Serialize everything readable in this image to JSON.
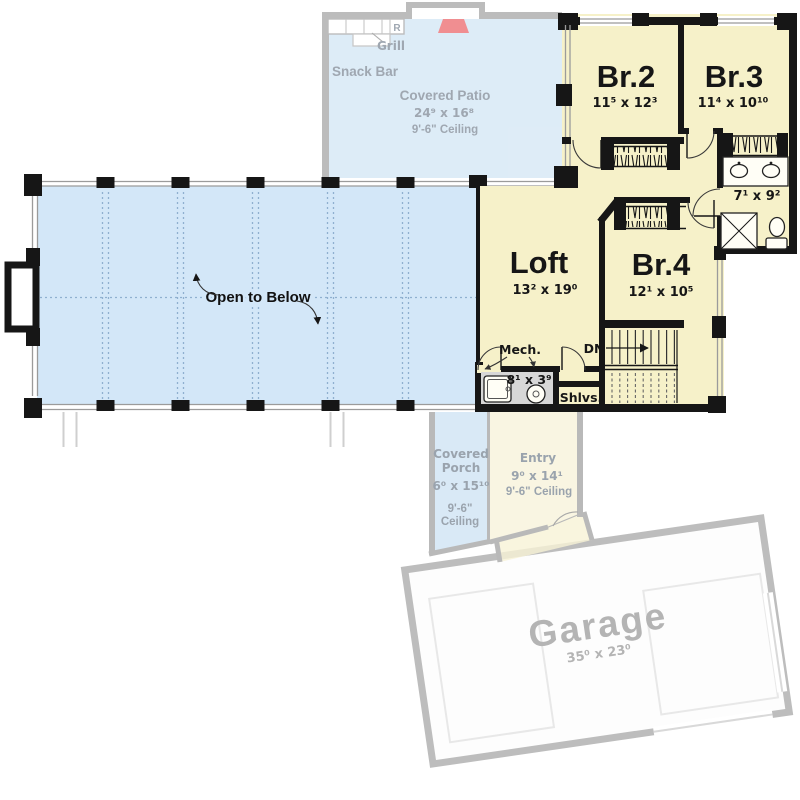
{
  "colors": {
    "room_fill": "#f6f1c9",
    "open_below_fill": "#d3e7f8",
    "patio_fill": "#dcebf7",
    "porch_fill": "#d9e9f6",
    "entry_fill": "#f9f5e2",
    "garage_fill": "#fdfdfd",
    "mech_fill": "#d7d7d7",
    "grill_red": "#f0898c",
    "wall_black": "#161616",
    "ghost_wall_gray": "#b9b9b9",
    "ghost_text_gray": "#9aa3ad",
    "grid_dot_blue": "#8fb0cf"
  },
  "rooms": {
    "br2": {
      "name": "Br.2",
      "dims": "11⁵ x 12³"
    },
    "br3": {
      "name": "Br.3",
      "dims": "11⁴ x 10¹⁰"
    },
    "br4": {
      "name": "Br.4",
      "dims": "12¹ x 10⁵"
    },
    "loft": {
      "name": "Loft",
      "dims": "13² x 19⁰"
    },
    "bath": {
      "dims": "7¹ x 9²"
    },
    "mech": {
      "name": "Mech.",
      "dims": "8¹ x 3⁹"
    },
    "shelves": {
      "name": "Shlvs."
    },
    "stairs": {
      "down_label": "DN"
    },
    "open_to_below": {
      "label": "Open to Below"
    }
  },
  "ghost_level": {
    "covered_patio": {
      "name": "Covered Patio",
      "dims": "24⁹ x 16⁸",
      "ceiling": "9'-6\" Ceiling",
      "snack_bar": "Snack Bar",
      "grill": "Grill",
      "fridge_abbr": "R"
    },
    "covered_porch": {
      "name_line1": "Covered",
      "name_line2": "Porch",
      "dims": "6⁰ x 15¹⁰",
      "ceiling_line1": "9'-6\"",
      "ceiling_line2": "Ceiling"
    },
    "entry": {
      "name": "Entry",
      "dims": "9⁰ x 14¹",
      "ceiling": "9'-6\" Ceiling"
    },
    "garage": {
      "name": "Garage",
      "dims": "35⁰ x 23⁰"
    }
  }
}
